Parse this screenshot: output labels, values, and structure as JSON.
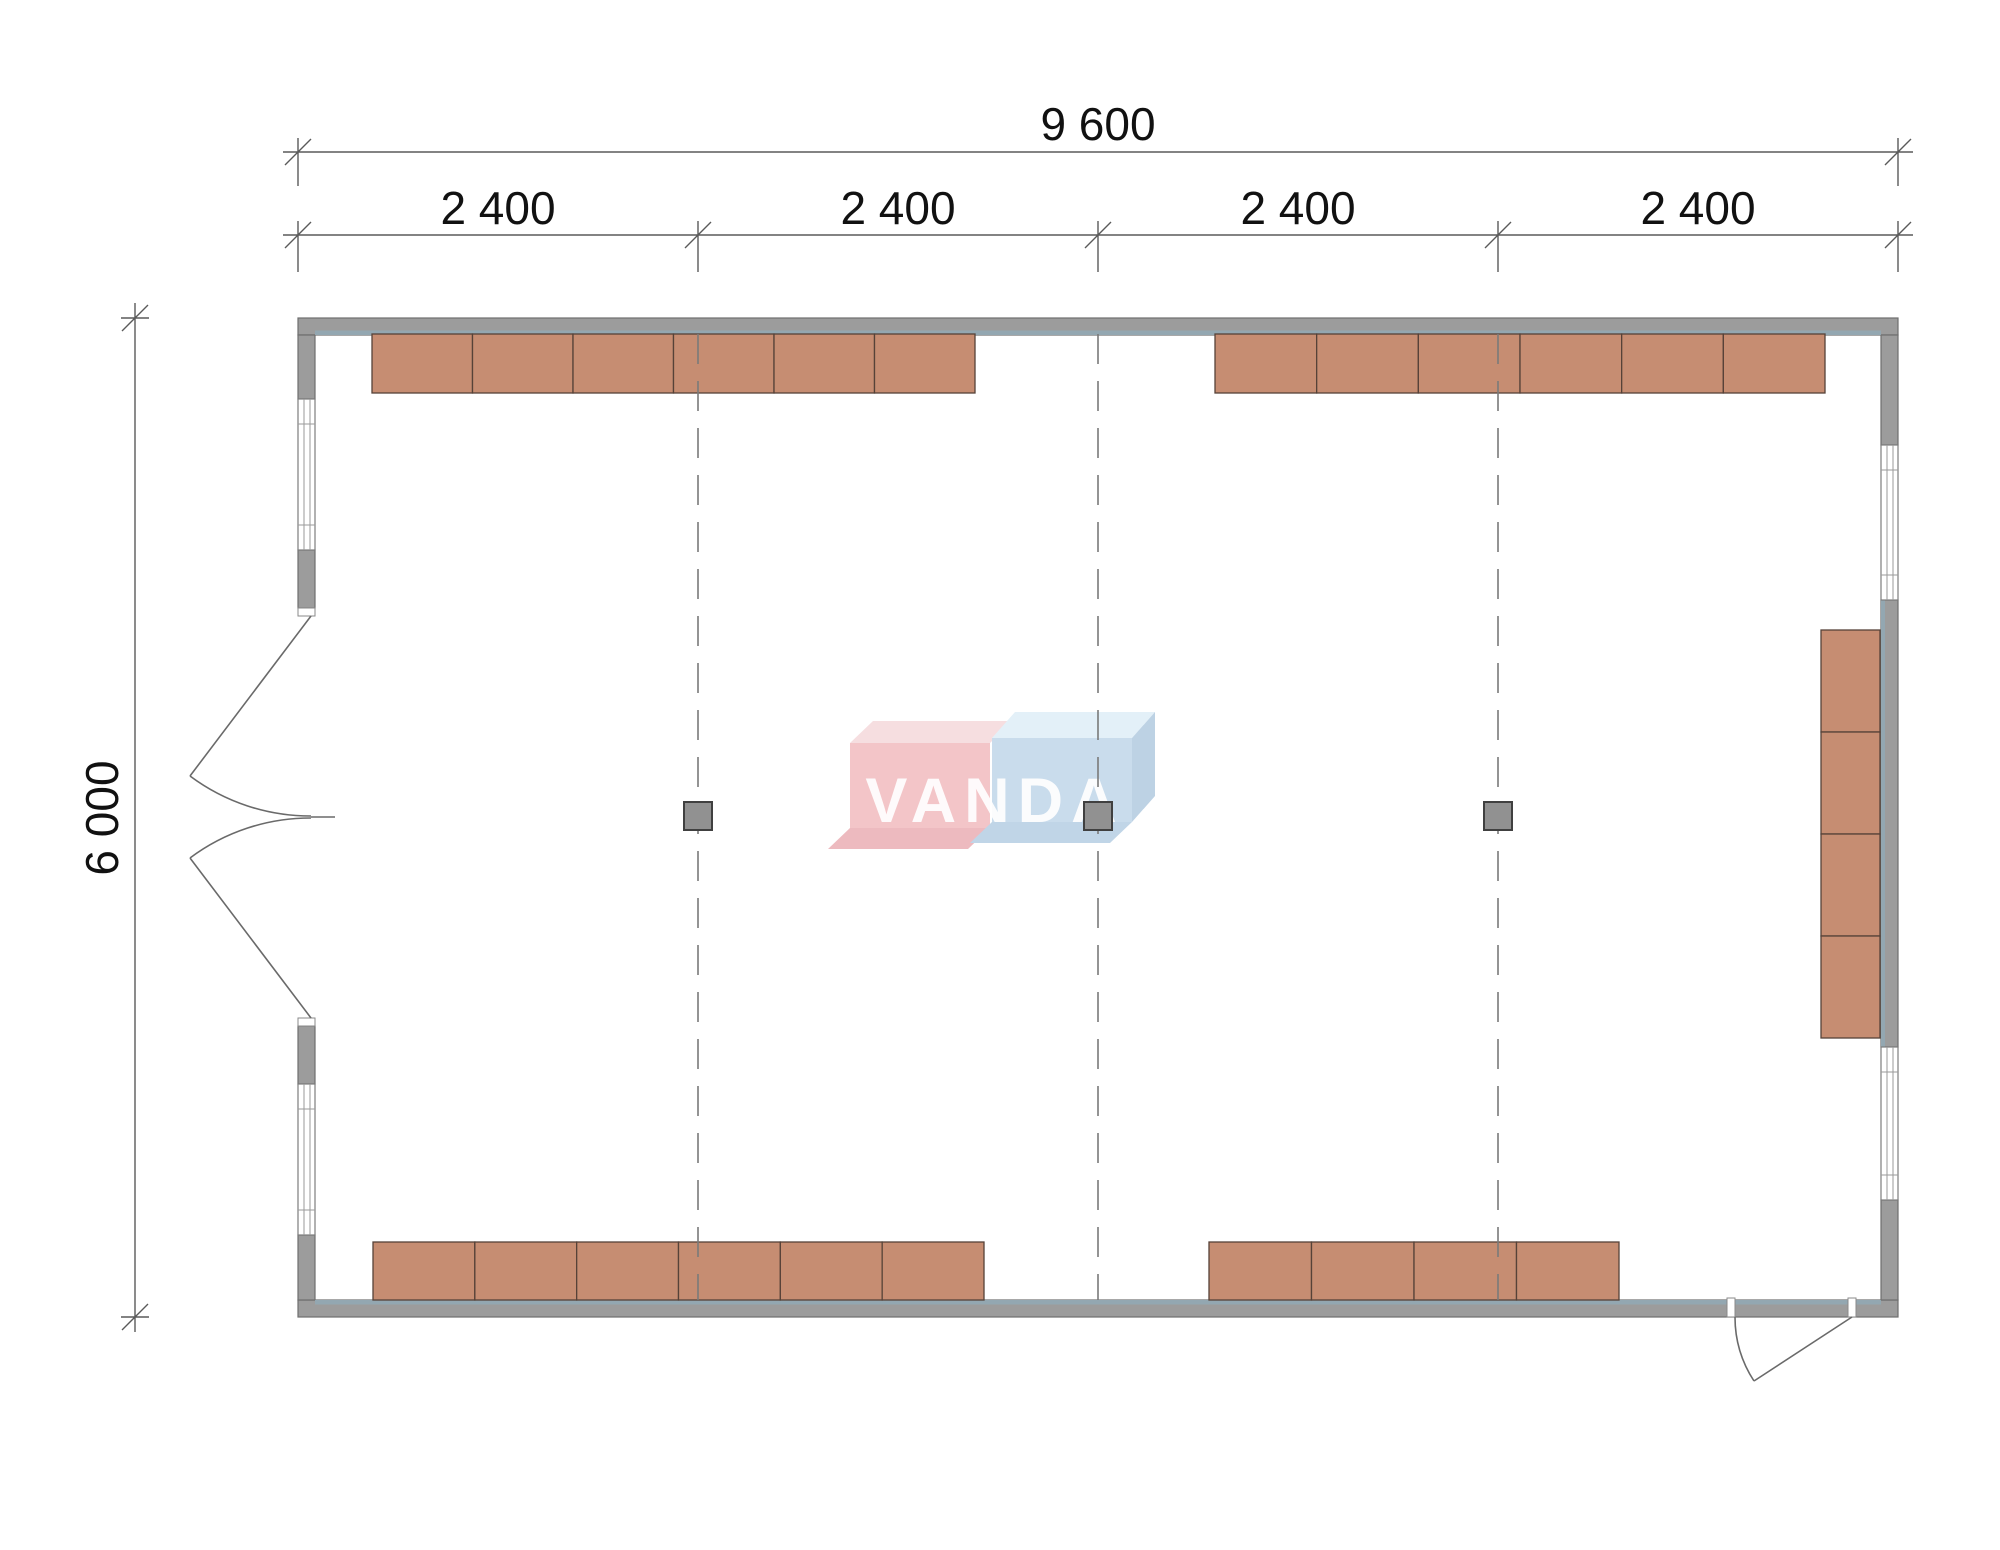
{
  "colors": {
    "wall_fill": "#9c9c9c",
    "wall_stroke": "#6f6f6f",
    "wall_inner_strip": "#93a7b1",
    "window_fill": "#ffffff",
    "window_stroke": "#7d7d7d",
    "furniture_fill": "#c68d72",
    "furniture_stroke": "#564238",
    "column_fill": "#919191",
    "column_stroke": "#404040",
    "grid_line": "#7a7a7a",
    "dim_line": "#5a5a5a",
    "dim_text": "#111111",
    "door_line": "#6a6a6a",
    "logo_pink_front": "#f3c5c8",
    "logo_pink_top": "#f6dee0",
    "logo_pink_bottom": "#edbabf",
    "logo_blue_front": "#c9dcec",
    "logo_blue_top": "#e3f0f8",
    "logo_blue_side": "#bdd2e4",
    "logo_blue_bottom": "#c0d5e7",
    "logo_text": "#ffffff"
  },
  "dimensions": {
    "overall_width_label": "9 600",
    "overall_height_label": "6 000",
    "segment_labels": [
      "2 400",
      "2 400",
      "2 400",
      "2 400"
    ]
  },
  "watermark": {
    "text": "VANDA"
  },
  "plan": {
    "furniture_rows": [
      {
        "name": "top-left-cabinet-row",
        "x": 372,
        "y": 334,
        "w": 603,
        "h": 59,
        "count": 6,
        "dir": "h"
      },
      {
        "name": "top-right-cabinet-row",
        "x": 1215,
        "y": 334,
        "w": 610,
        "h": 59,
        "count": 6,
        "dir": "h"
      },
      {
        "name": "bottom-left-cabinet-row",
        "x": 373,
        "y": 1242,
        "w": 611,
        "h": 58,
        "count": 6,
        "dir": "h"
      },
      {
        "name": "bottom-right-cabinet-row",
        "x": 1209,
        "y": 1242,
        "w": 410,
        "h": 58,
        "count": 4,
        "dir": "h"
      },
      {
        "name": "right-wall-cabinet-stack",
        "x": 1821,
        "y": 630,
        "w": 59,
        "h": 408,
        "count": 4,
        "dir": "v"
      }
    ],
    "grid": {
      "xs": [
        698,
        1098,
        1498
      ],
      "y1": 334,
      "y2": 1300
    },
    "columns": {
      "size": 28,
      "centers": [
        [
          698,
          816
        ],
        [
          1098,
          816
        ],
        [
          1498,
          816
        ]
      ]
    }
  }
}
